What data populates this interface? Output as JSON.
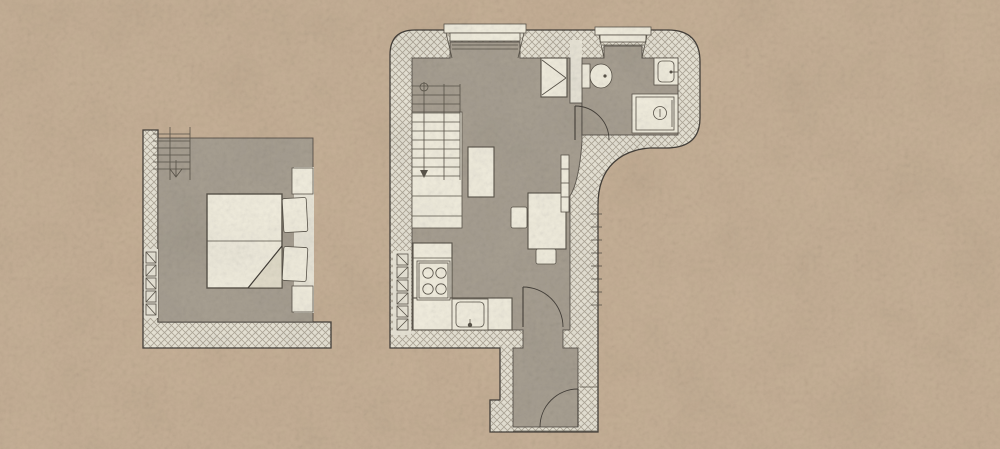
{
  "scene": {
    "kind": "hand-drawn architectural floor plan",
    "texture": "mottled scanned paper",
    "plans_count": 2
  },
  "palette": {
    "background": "#c7b197",
    "floor": "#a8a092",
    "wall_fill": "#eae6d8",
    "hatch_line": "#b2aa9b",
    "outline": "#45403a",
    "furniture_fill": "#f2eedf",
    "furniture_line": "#5a544a",
    "shade_fill": "#e4decb"
  },
  "bedroom_plan": {
    "name": "bedroom-mezzanine",
    "walls": "cross-hatched on left and bottom, thin lines top and right",
    "furniture": [
      {
        "icon": "stairs-icon",
        "label": "staircase with down arrow"
      },
      {
        "icon": "double-bed-icon",
        "label": "double bed, two mattresses, folded blanket corner"
      },
      {
        "icon": "pillow-icon",
        "label": "two pillows"
      },
      {
        "icon": "nightstand-icon",
        "label": "nightstand top"
      },
      {
        "icon": "nightstand-icon",
        "label": "nightstand bottom"
      },
      {
        "icon": "radiator-icon",
        "label": "wall radiator, five segments"
      }
    ]
  },
  "main_plan": {
    "name": "main-apartment",
    "shape": "L-shaped outline with rounded outer corners and curved wall below bathroom",
    "rooms": [
      "living-kitchen",
      "bathroom",
      "entrance-hall"
    ],
    "openings": [
      {
        "icon": "window-icon",
        "label": "living room bay window, top wall"
      },
      {
        "icon": "window-icon",
        "label": "bathroom window, top wall"
      },
      {
        "icon": "door-icon",
        "label": "bathroom door with swing arc"
      },
      {
        "icon": "door-icon",
        "label": "hall door with swing arc"
      },
      {
        "icon": "door-icon",
        "label": "entrance door with swing arc"
      }
    ],
    "furniture": [
      {
        "icon": "stairs-icon",
        "label": "staircase over closet"
      },
      {
        "icon": "closet-icon",
        "label": "under-stair storage"
      },
      {
        "icon": "desk-icon",
        "label": "small table / shelf"
      },
      {
        "icon": "wardrobe-icon",
        "label": "wardrobe with diagonal marks"
      },
      {
        "icon": "toilet-icon",
        "label": "toilet"
      },
      {
        "icon": "washbasin-icon",
        "label": "washbasin"
      },
      {
        "icon": "shower-icon",
        "label": "shower tray with drain"
      },
      {
        "icon": "dining-table-icon",
        "label": "dining table with two chairs"
      },
      {
        "icon": "radiator-icon",
        "label": "wall radiator beside table"
      },
      {
        "icon": "radiator-icon",
        "label": "kitchen wall radiator, six segments"
      },
      {
        "icon": "stove-icon",
        "label": "cooktop with four burners"
      },
      {
        "icon": "kitchen-sink-icon",
        "label": "kitchen sink with tap"
      },
      {
        "icon": "counter-icon",
        "label": "L-shaped kitchen counter"
      }
    ]
  }
}
